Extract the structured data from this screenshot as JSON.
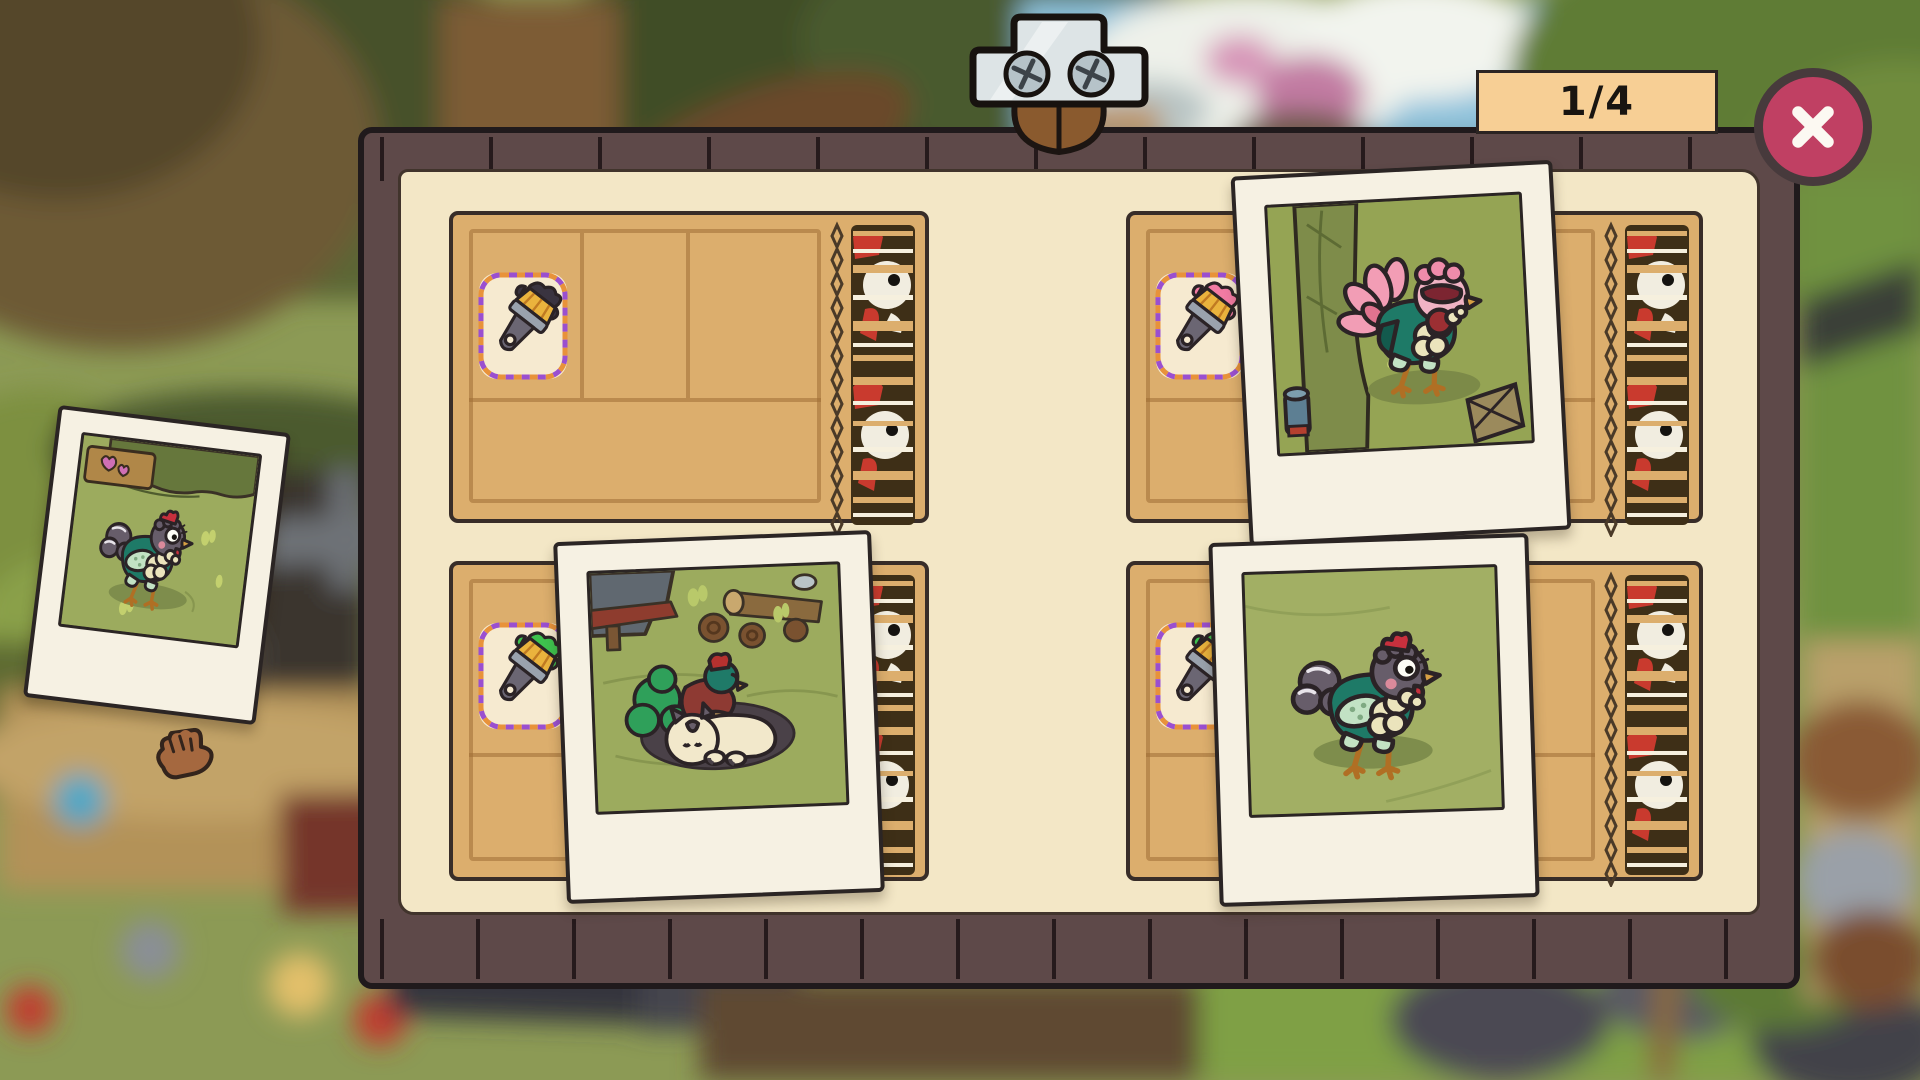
{
  "screen": {
    "type": "photo-album-board",
    "overlay": true
  },
  "header": {
    "progress_counter": "1/4",
    "close_button": {
      "icon": "x-icon",
      "label": "Close"
    }
  },
  "board": {
    "stub_motif": "chicken-head-barcode",
    "slots": [
      {
        "position": "top-left",
        "brush_paint": "#3a3440",
        "brush_paint_name": "black",
        "photo": null
      },
      {
        "position": "top-right",
        "brush_paint": "#f27ba3",
        "brush_paint_name": "pink",
        "photo": {
          "placed": true,
          "subject": "pink-frilled chicken beside tree trunk"
        }
      },
      {
        "position": "bottom-left",
        "brush_paint": "#3ec24e",
        "brush_paint_name": "green",
        "photo": {
          "placed": true,
          "subject": "green-tailed chicken cuddling cream cat by logs"
        }
      },
      {
        "position": "bottom-right",
        "brush_paint": "#3ec24e",
        "brush_paint_name": "green",
        "photo": {
          "placed": true,
          "subject": "gray chicken standing in grass"
        }
      }
    ]
  },
  "drag_photo": {
    "state": "unplaced",
    "subject": "gray chicken near heart sign"
  },
  "cursor": {
    "type": "hand-grab"
  },
  "colors": {
    "board_frame": "#5e4949",
    "parchment": "#f3e7c6",
    "ticket": "#dcae6d",
    "badge_bg": "#f7cf95",
    "close_bg": "#c04063",
    "photo_frame": "#f6f1e3",
    "stub_red": "#c93a2e"
  }
}
